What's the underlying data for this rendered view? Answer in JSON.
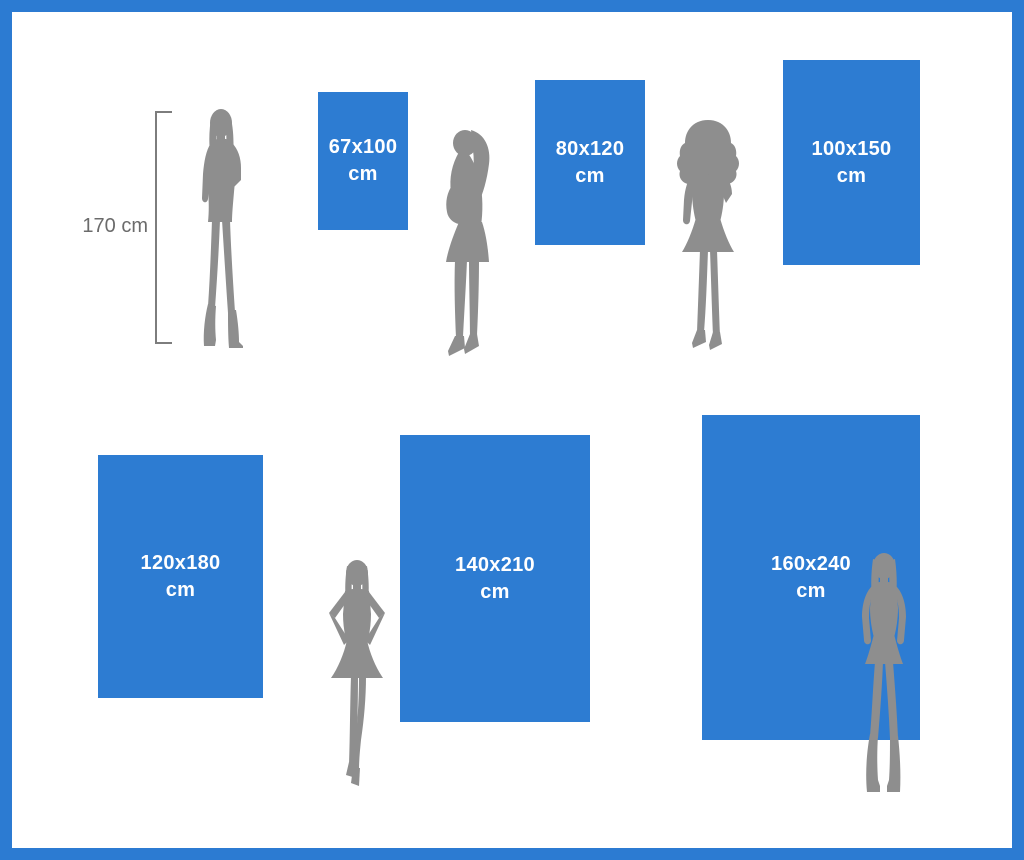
{
  "reference": {
    "height_label": "170 cm"
  },
  "sizes": [
    {
      "dims": "67x100",
      "unit": "cm"
    },
    {
      "dims": "80x120",
      "unit": "cm"
    },
    {
      "dims": "100x150",
      "unit": "cm"
    },
    {
      "dims": "120x180",
      "unit": "cm"
    },
    {
      "dims": "140x210",
      "unit": "cm"
    },
    {
      "dims": "160x240",
      "unit": "cm"
    }
  ],
  "figures": [
    {
      "name": "woman-front-hand-on-hip"
    },
    {
      "name": "woman-side-profile"
    },
    {
      "name": "woman-curly-hair-hand-to-chin"
    },
    {
      "name": "woman-hands-on-hips"
    },
    {
      "name": "woman-standing-boots"
    }
  ],
  "colors": {
    "rect_blue": "#2d7cd2",
    "frame_blue": "#2c7bd2",
    "silhouette_gray": "#8e8e8e",
    "measure_gray": "#6b6b6b",
    "label_white": "#ffffff",
    "background": "#ffffff"
  }
}
